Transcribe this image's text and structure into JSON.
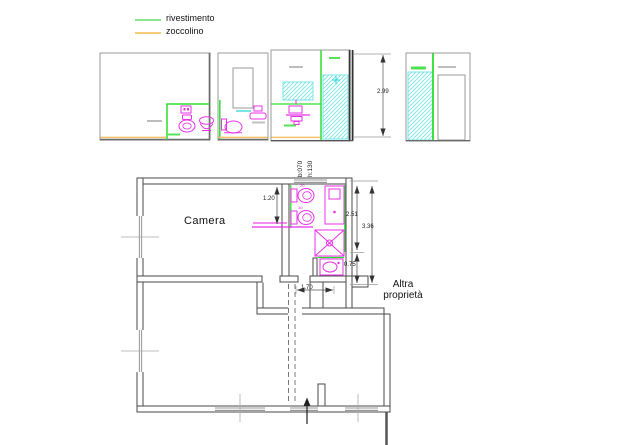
{
  "legend": {
    "items": [
      {
        "id": "rivestimento",
        "label": "rivestimento",
        "color": "#8ce88c"
      },
      {
        "id": "zoccolino",
        "label": "zoccolino",
        "color": "#f5cd7a"
      }
    ]
  },
  "plan": {
    "room_labels": {
      "camera": "Camera",
      "altra_line1": "Altra",
      "altra_line2": "proprietà"
    },
    "window_note": {
      "b": "b:070",
      "h": "h:130"
    },
    "dimensions": {
      "elevation_height": "2.99",
      "camera_niche": "1.20",
      "bath_upper": "2.51",
      "bath_total": "3.36",
      "niche": "0.75",
      "corridor": "1.70"
    },
    "fixture_codes": {
      "wc": "20",
      "bidet": "30"
    }
  },
  "colors": {
    "rivestimento_line": "#2edd2e",
    "zoccolino_line": "#f2c36b",
    "fixtures": "#e832e8",
    "tile_hatch": "#7ae4e4",
    "walls": "#4a4a4a"
  }
}
